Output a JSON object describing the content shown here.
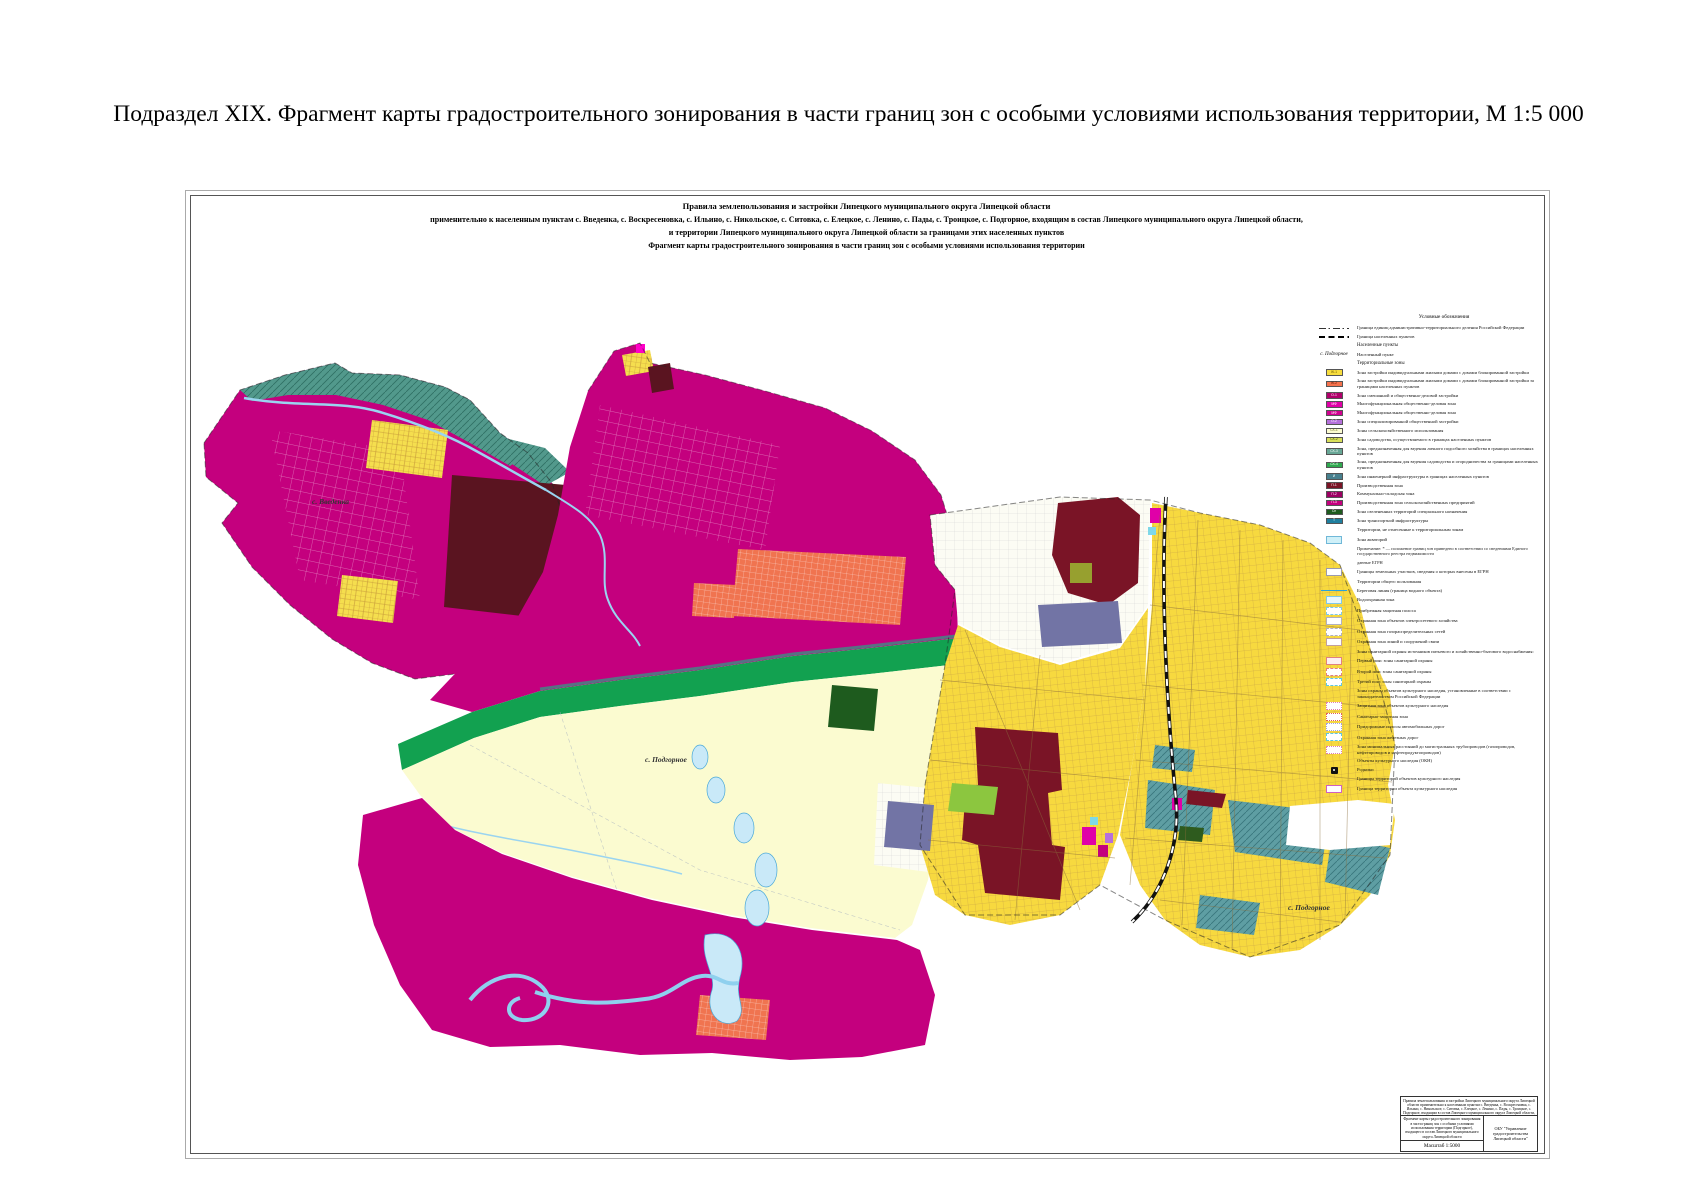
{
  "page": {
    "title": "Подраздел XIX. Фрагмент карты градостроительного зонирования в части границ зон с особыми условиями использования территории, М 1:5 000"
  },
  "map_header": {
    "line1": "Правила землепользования и застройки Липецкого муниципального округа Липецкой области",
    "line2": "применительно к населенным пунктам с. Введенка, с. Воскресеновка, с. Ильино, с. Никольское,  с. Ситовка, с. Елецкое, с. Ленино, с. Пады, с. Троицкое, с. Подгорное, входящим в состав Липецкого муниципального округа Липецкой области,",
    "line3": "и территории Липецкого муниципального округа Липецкой области  за границами  этих населенных пунктов",
    "line4": "Фрагмент карты градостроительного зонирования в части границ зон с особыми условиями использования территории"
  },
  "map_labels": {
    "upper_left": "с. Введенка",
    "center": "с. Подгорное",
    "right": "с. Подгорное"
  },
  "legend": {
    "title": "Условные обозначения",
    "items": [
      {
        "type": "line_admin",
        "icon": "admin-boundary-line-icon",
        "label": "Граница единиц административно-территориального деления Российской Федерации"
      },
      {
        "type": "line_settlement",
        "icon": "settlement-boundary-line-icon",
        "label": "Граница населенных пунктов"
      },
      {
        "type": "subheader",
        "label": "Населенные пункты"
      },
      {
        "type": "sample",
        "symbol": "с. Подгорное",
        "icon": "settlement-name-sample",
        "label": "Населенный пункт"
      },
      {
        "type": "subheader",
        "label": "Территориальные зоны"
      },
      {
        "type": "swatch",
        "code": "Ж-1",
        "color": "#F7DD3E",
        "code_color": "#6E5800",
        "label": "Зона застройки индивидуальными жилыми домами с домами блокированной застройки"
      },
      {
        "type": "swatch",
        "code": "Ж-2",
        "color": "#F4724D",
        "code_color": "#5C1600",
        "label": "Зона застройки индивидуальными жилыми домами с домами блокированной застройки за границами населенных пунктов"
      },
      {
        "type": "swatch",
        "code": "О-1",
        "color": "#B0006B",
        "code_color": "#FFFFFF",
        "label": "Зона смешанной и общественно-деловой застройки"
      },
      {
        "type": "swatch",
        "code": "МФ",
        "color": "#E000A8",
        "code_color": "#FFFFFF",
        "label": "Многофункциональная общественно-деловая зона"
      },
      {
        "type": "swatch",
        "code": "МФ",
        "color": "#D10090",
        "code_color": "#FFFFFF",
        "label": "Многофункциональная общественно-деловая зона"
      },
      {
        "type": "swatch",
        "code": "О-2",
        "color": "#B570DB",
        "code_color": "#FFFFFF",
        "label": "Зона специализированной общественной застройки"
      },
      {
        "type": "swatch",
        "code": "СХ-1",
        "color": "#FBFBD0",
        "code_color": "#6E6E20",
        "light": true,
        "label": "Зоны сельскохозяйственного использования"
      },
      {
        "type": "swatch",
        "code": "СХ-2",
        "color": "#D9E05A",
        "code_color": "#3F4C00",
        "label": "Зона садоводства, осуществляемого в границах населенных пунктов"
      },
      {
        "type": "swatch",
        "code": "СХ-3",
        "color": "#68A796",
        "code_color": "#FFFFFF",
        "label": "Зона, предназначенная для ведения личного подсобного хозяйства в границах населенных пунктов"
      },
      {
        "type": "swatch",
        "code": "СХ-4",
        "color": "#2FA84F",
        "code_color": "#FFFFFF",
        "label": "Зона, предназначенная для ведения садоводства и огородничества за границами населенных пунктов"
      },
      {
        "type": "swatch",
        "code": "И",
        "color": "#47808E",
        "code_color": "#FFFFFF",
        "label": "Зона инженерной инфраструктуры в границах населенных пунктов"
      },
      {
        "type": "swatch",
        "code": "П-1",
        "color": "#7A1426",
        "code_color": "#FFFFFF",
        "label": "Производственная зона"
      },
      {
        "type": "swatch",
        "code": "П-2",
        "color": "#9C0063",
        "code_color": "#FFFFFF",
        "label": "Коммунально-складская зона"
      },
      {
        "type": "swatch",
        "code": "П-3",
        "color": "#C4007E",
        "code_color": "#FFFFFF",
        "label": "Производственная зона сельскохозяйственных предприятий"
      },
      {
        "type": "swatch",
        "code": "Сп",
        "color": "#1E5B1E",
        "code_color": "#FFFFFF",
        "label": "Зона озелененных территорий специального назначения"
      },
      {
        "type": "swatch",
        "code": "Т",
        "color": "#1F7F9F",
        "code_color": "#FFFFFF",
        "label": "Зона транспортной инфраструктуры"
      },
      {
        "type": "none",
        "label": "Территории, не отнесенные к территориальным зонам"
      },
      {
        "type": "box",
        "border": "0.7px solid #70B8D8",
        "fill": "#CFF0F8",
        "label": "Зона акваторий"
      },
      {
        "type": "note",
        "label": "Примечание: * — положение границ зон приведено в соответствии со сведениями Единого государственного реестра недвижимости"
      },
      {
        "type": "note",
        "label": "данные ЕГРН"
      },
      {
        "type": "box",
        "border": "0.7px solid #9A9AB0",
        "fill": "#FFFFFF",
        "label": "Границы земельных участков, сведения о которых внесены в ЕГРН"
      },
      {
        "type": "none",
        "label": "Территории общего пользования"
      },
      {
        "type": "wave",
        "icon": "shoreline-icon",
        "label": "Береговая линия (граница водного объекта)"
      },
      {
        "type": "box",
        "border": "0.7px solid #7FC8E8",
        "fill": "#E8F7FD",
        "label": "Водоохранная зона"
      },
      {
        "type": "box",
        "border": "0.7px dashed #7FC8E8",
        "fill": "#FFFFFF",
        "label": "Прибрежная защитная полоса"
      },
      {
        "type": "box",
        "border": "0.7px solid #B0B0C0",
        "fill": "#FFFFFF",
        "label": "Охранная зона объектов электросетевого хозяйства"
      },
      {
        "type": "box",
        "border": "0.7px dashed #B0B0C0",
        "fill": "#FFFFFF",
        "label": "Охранная зона газораспределительных сетей"
      },
      {
        "type": "box",
        "border": "0.7px solid #C0A0A0",
        "fill": "#FFFFFF",
        "label": "Охранная зона линий и сооружений связи"
      },
      {
        "type": "none",
        "label": "Зоны санитарной охраны источников питьевого и хозяйственно-бытового водоснабжения:"
      },
      {
        "type": "box",
        "border": "0.8px solid #E08080",
        "fill": "#FDF0F0",
        "label": "Первый пояс зоны санитарной охраны"
      },
      {
        "type": "box",
        "border": "0.8px dashed #E08080",
        "fill": "#FFFFFF",
        "label": "Второй пояс зоны санитарной охраны"
      },
      {
        "type": "box",
        "border": "0.8px dashed #60C8E0",
        "fill": "#FFFFFF",
        "label": "Третий пояс зоны санитарной охраны"
      },
      {
        "type": "none",
        "label": "Зоны охраны объектов культурного наследия, установленные в соответствии с законодательством Российской Федерации"
      },
      {
        "type": "box",
        "border": "0.8px dotted #E080B0",
        "fill": "#FFFFFF",
        "label": "Защитная зона объектов культурного наследия"
      },
      {
        "type": "box",
        "border": "0.8px dotted #E06060",
        "fill": "#FFFFFF",
        "label": "Санитарно-защитная зона"
      },
      {
        "type": "box",
        "border": "0.8px dotted #A0A0E0",
        "fill": "#FFFFFF",
        "label": "Придорожные полосы автомобильных дорог"
      },
      {
        "type": "box",
        "border": "0.8px dashed #60C8E0",
        "fill": "#FFFFFF",
        "label": "Охранная зона железных дорог"
      },
      {
        "type": "box",
        "border": "0.8px dotted #E080B0",
        "fill": "#FFFFFF",
        "label": "Зона минимальных расстояний до магистральных трубопроводов (газопроводов, нефтепроводов и нефтепродуктопроводов)"
      },
      {
        "type": "none",
        "label": "Объекты культурного наследия (ОКН)"
      },
      {
        "type": "spring",
        "icon": "spring-icon",
        "label": "Родники"
      },
      {
        "type": "none",
        "label": "Границы территорий объектов культурного наследия"
      },
      {
        "type": "box",
        "border": "0.8px solid #D060C0",
        "fill": "#FFFFFF",
        "label": "Граница территории объекта культурного наследия"
      }
    ]
  },
  "title_block": {
    "row1": "Правила землепользования и застройки Липецкого муниципального округа Липецкой области применительно к населенным пунктам с. Введенка, с. Воскресеновка, с. Ильино, с. Никольское, с. Ситовка, с. Елецкое, с. Ленино, с. Пады, с. Троицкое, с. Подгорное, входящим в состав Липецкого муниципального округа Липецкой области, и территории Липецкого муниципального округа Липецкой области за границами этих населенных пунктов",
    "doc_title": "Фрагмент карты градостроительного зонирования в части границ зон с особыми условиями использования территории (Подгорное), входящего в состав Липецкого муниципального округа Липецкой области",
    "org": "ОБУ \"Управление градостроительства Липецкой области\"",
    "scale": "Масштаб 1:5000"
  },
  "colors": {
    "zone_magenta": "#C4007E",
    "zone_yellow_settlement": "#F7D93F",
    "zone_cream_agric": "#FBFBD0",
    "zone_green_belt": "#12A150",
    "zone_teal": "#5E9EA3",
    "zone_dark_red_industrial": "#7A1426",
    "zone_dark_maroon": "#5A1420",
    "zone_orange": "#F07450",
    "water": "#C9E9F8"
  }
}
